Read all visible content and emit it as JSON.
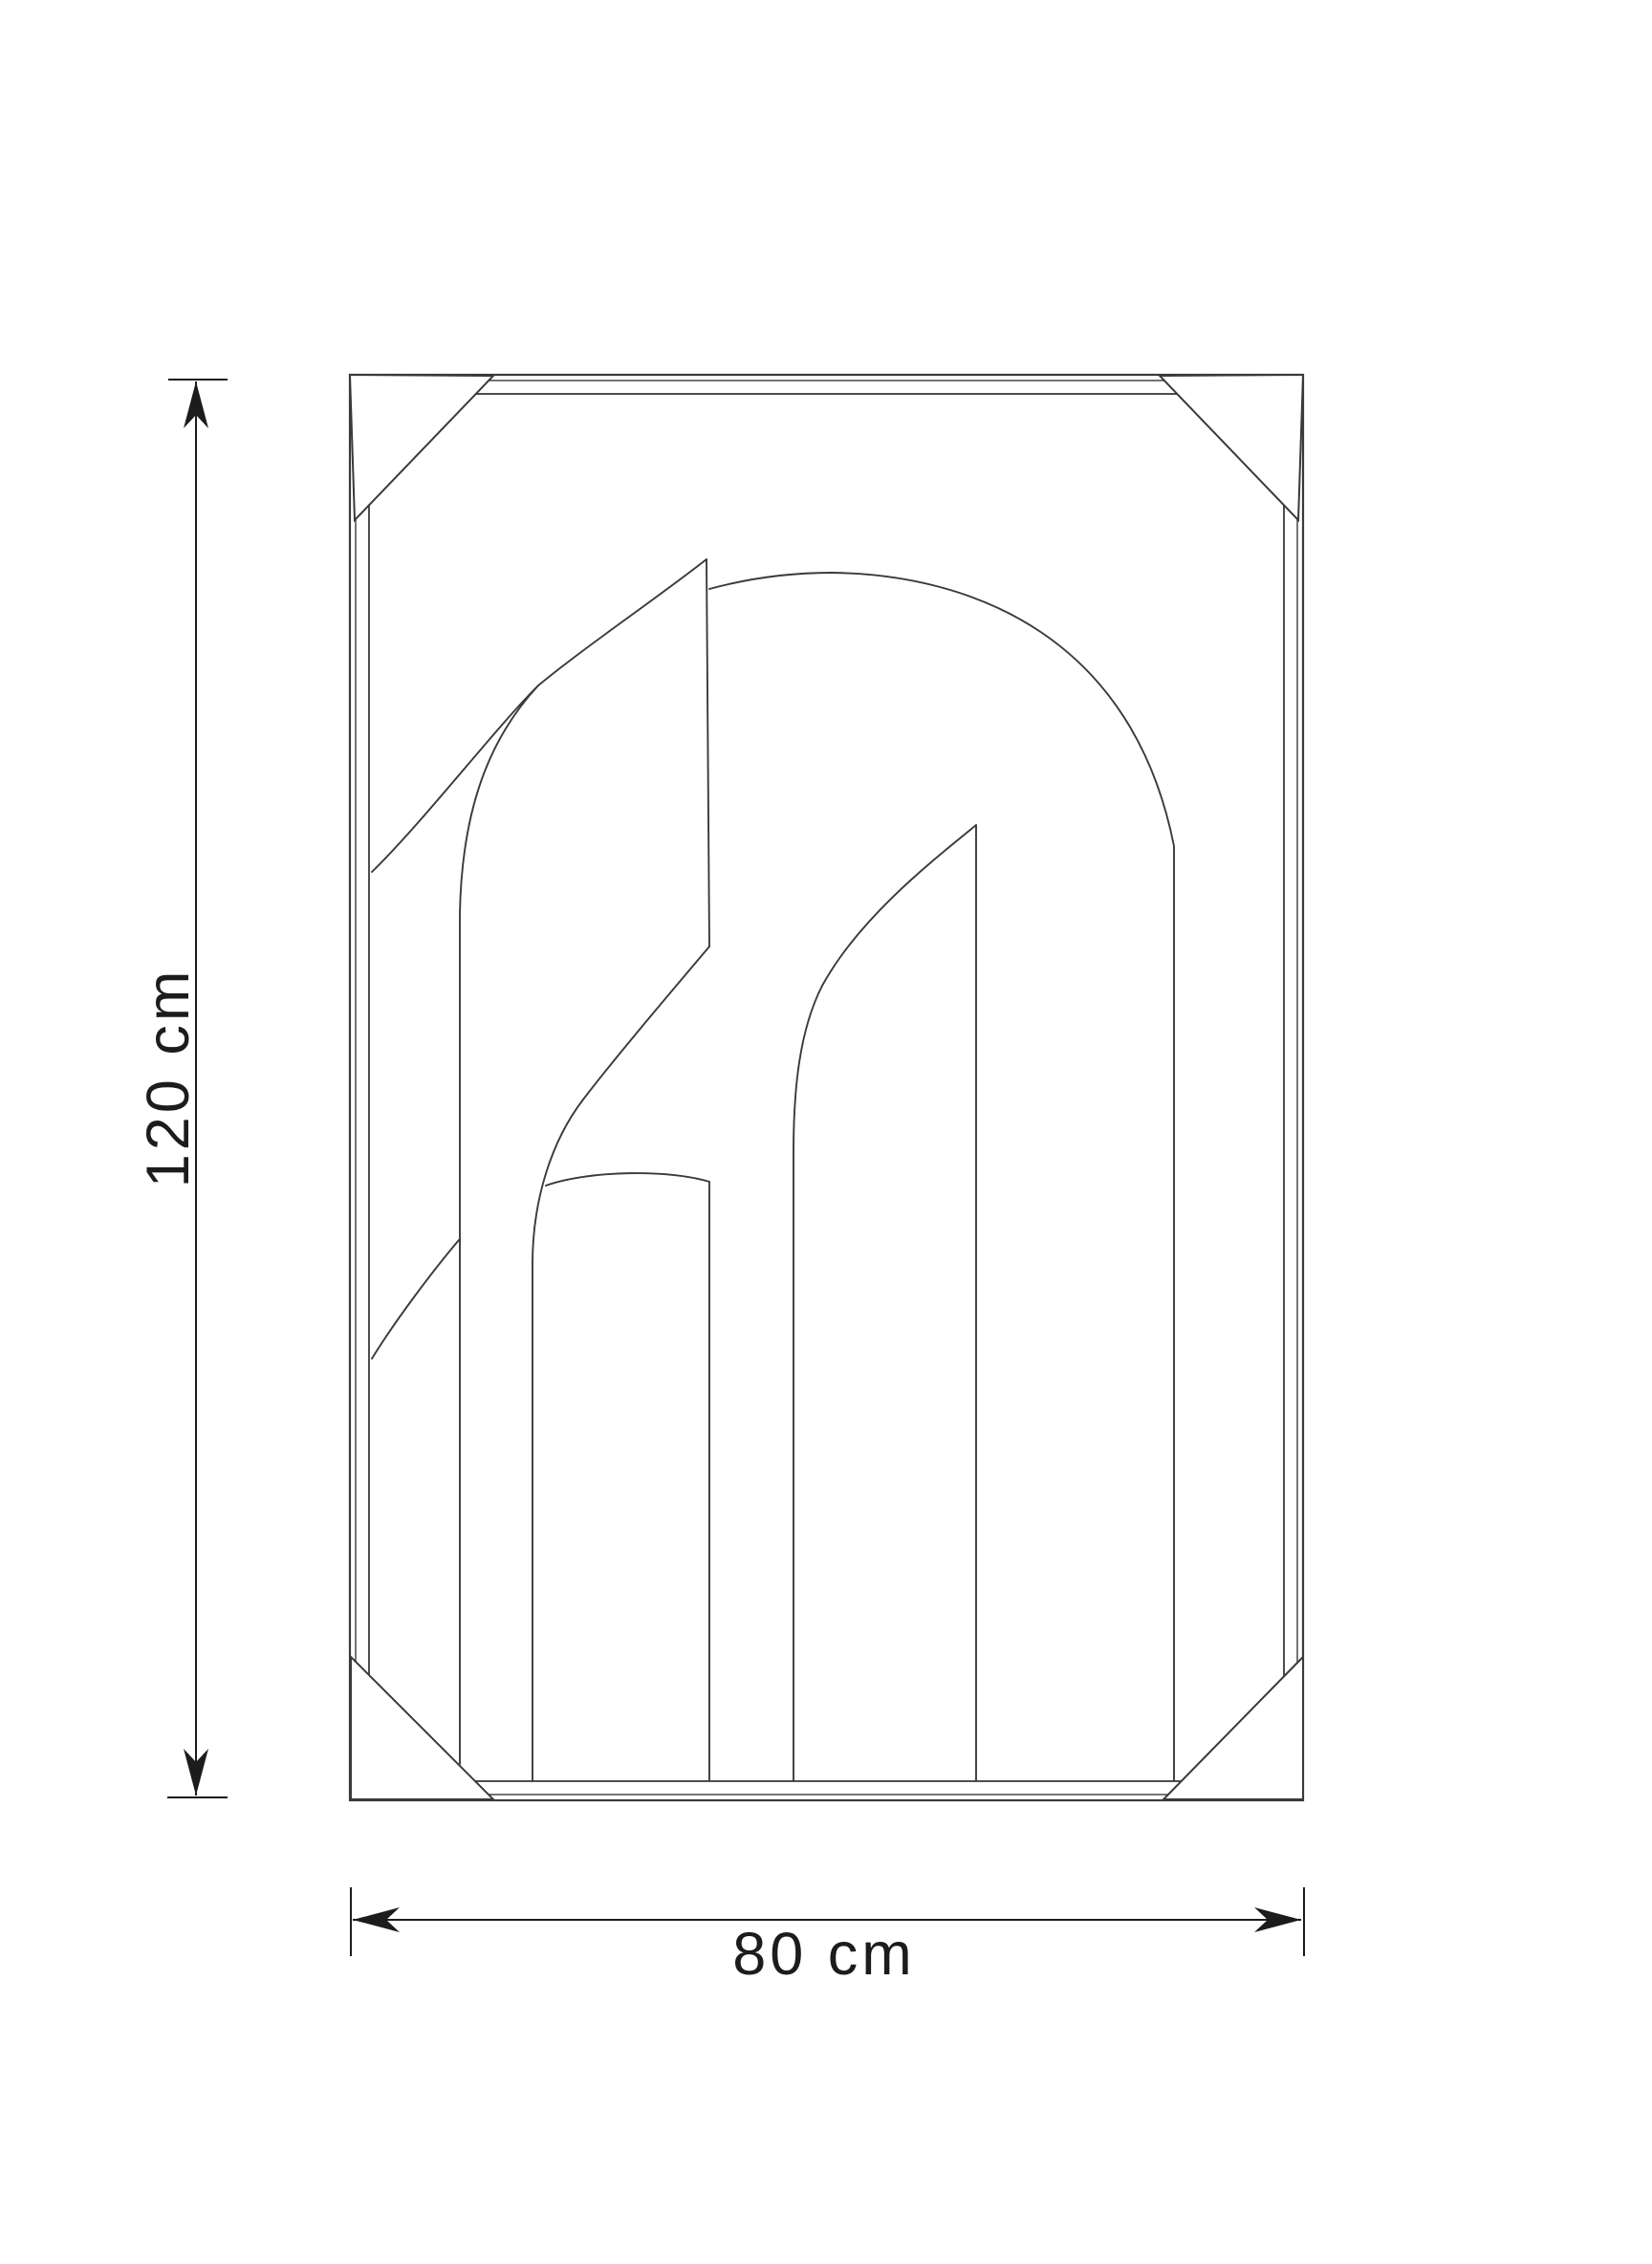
{
  "diagram": {
    "type": "product-dimension-drawing",
    "subject": "Framed wall art with abstract arch line artwork, corner protectors and size arrows",
    "dimensions": {
      "height": {
        "label": "120 cm",
        "value": 120,
        "unit": "cm",
        "orientation": "vertical"
      },
      "width": {
        "label": "80 cm",
        "value": 80,
        "unit": "cm",
        "orientation": "horizontal"
      }
    },
    "colors": {
      "background": "#ffffff",
      "artwork_line": "#3a3a3a",
      "frame_line": "#3a3a3a",
      "dimension_line": "#1c1c1c",
      "label_text": "#1c1c1c"
    }
  }
}
